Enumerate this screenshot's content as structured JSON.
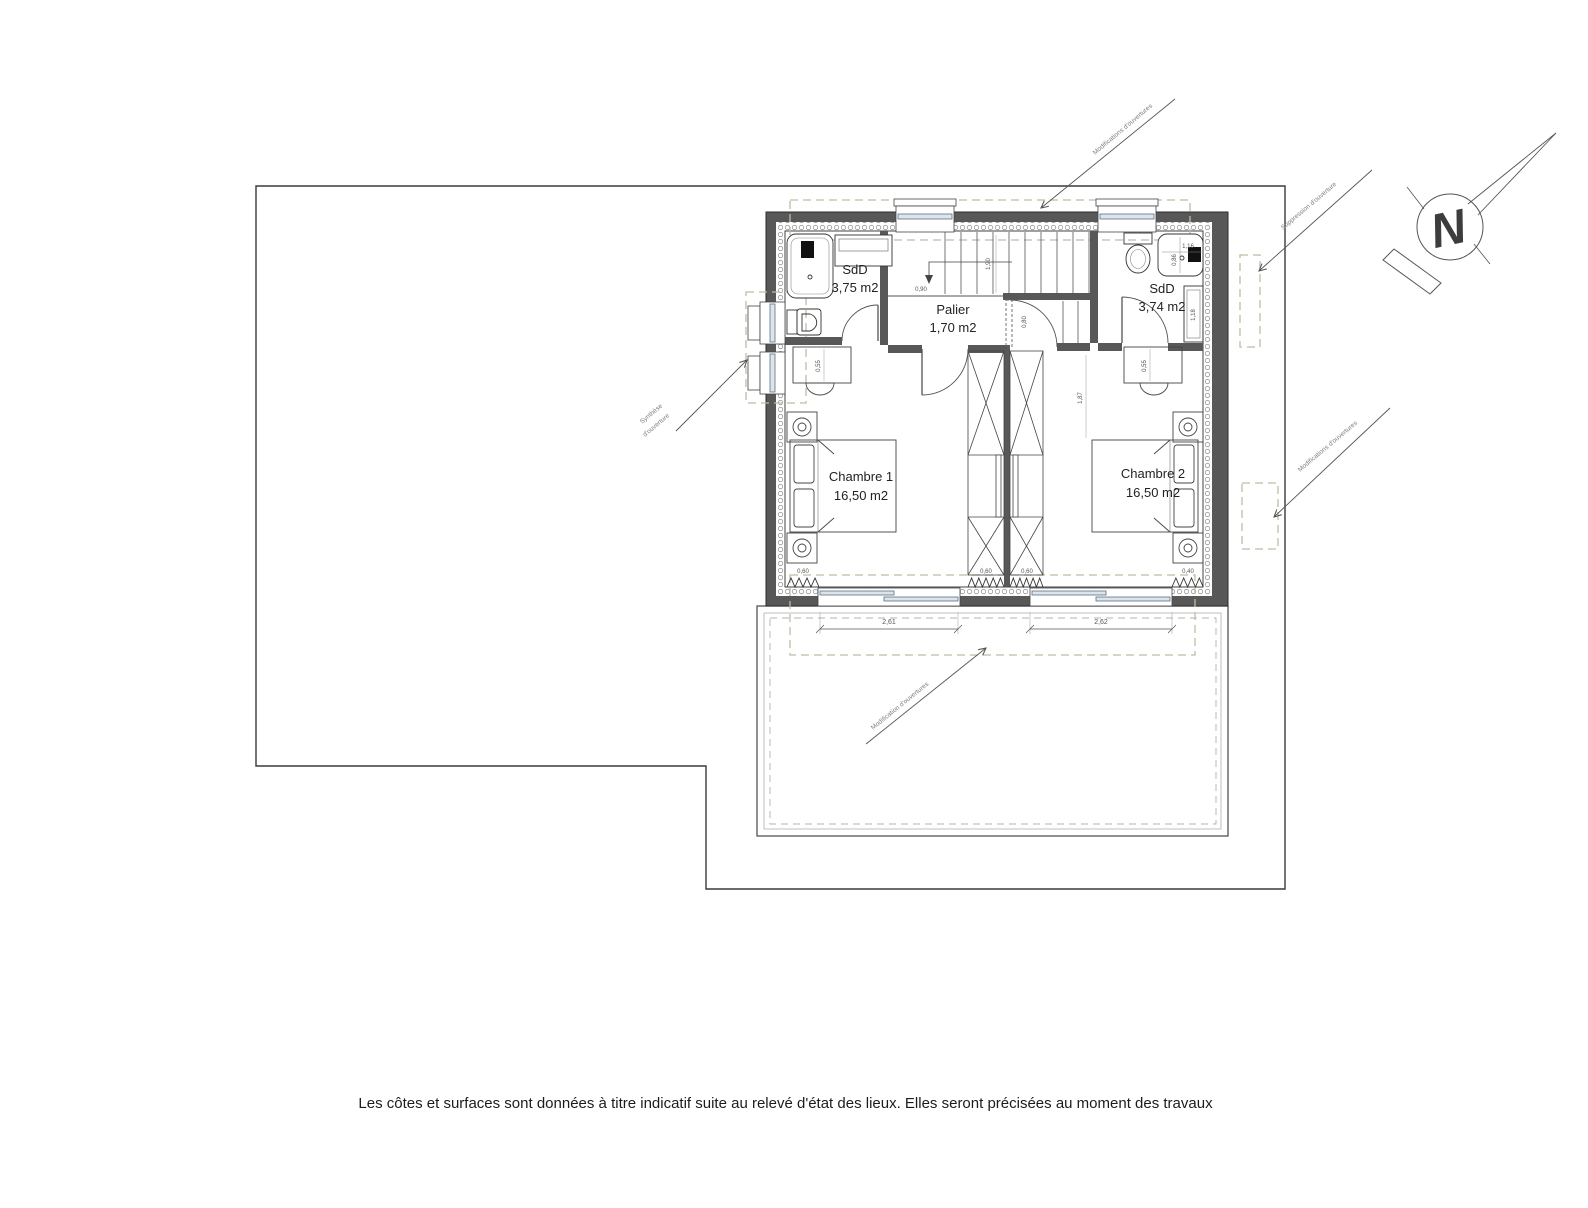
{
  "rooms": {
    "sdd_left": {
      "name": "SdD",
      "area": "3,75 m2"
    },
    "palier": {
      "name": "Palier",
      "area": "1,70 m2"
    },
    "sdd_right": {
      "name": "SdD",
      "area": "3,74 m2"
    },
    "chambre1": {
      "name": "Chambre 1",
      "area": "16,50 m2"
    },
    "chambre2": {
      "name": "Chambre 2",
      "area": "16,50 m2"
    }
  },
  "annotations": {
    "top": "Modifications d'ouvertures",
    "top_right": "Suppression d'ouverture",
    "left_l1": "Synthèse",
    "left_l2": "d'ouverture",
    "right": "Modifications d'ouvertures",
    "bottom": "Modification d'ouvertures"
  },
  "dimensions": {
    "bay_left": "2,61",
    "bay_right": "2,62",
    "stair_run": "1,90",
    "palier_width": "0,90",
    "door_c2": "0,80",
    "shower_w": "1,16",
    "shower_d": "0,86",
    "towel_rail": "1,18",
    "desk1": "0,55",
    "desk2": "0,55",
    "bed2_clearance": "1,87",
    "rad1": "0,60",
    "rad2": "0,60",
    "rad3": "0,60",
    "rad4": "0,40"
  },
  "compass": {
    "north": "N"
  },
  "footer": {
    "note": "Les côtes et surfaces sont données à titre indicatif suite au relevé d'état des lieux. Elles seront précisées au moment des travaux"
  },
  "colors": {
    "wall": "#585858",
    "zone_dash": "#b6c1a4",
    "glazing": "#5b7285"
  }
}
